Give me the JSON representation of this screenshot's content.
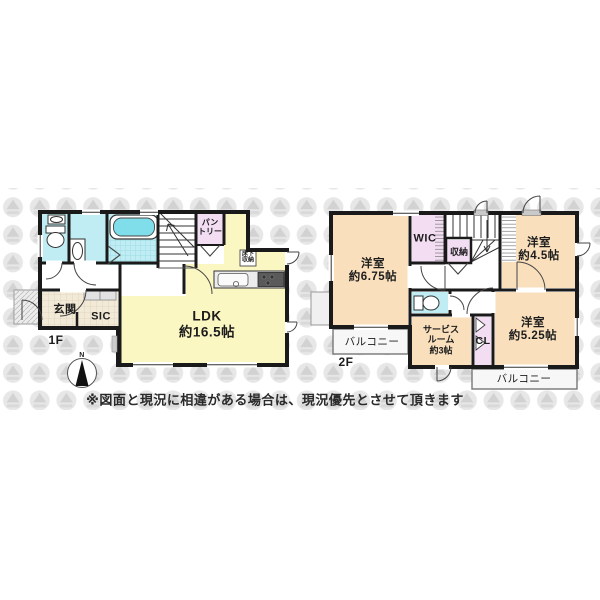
{
  "floor1": {
    "floor_label": "1F",
    "rooms": {
      "ldk": {
        "line1": "LDK",
        "line2": "約16.5帖"
      },
      "genkan": {
        "label": "玄関"
      },
      "sic": {
        "label": "SIC"
      },
      "pantry": {
        "line1": "パン",
        "line2": "トリー"
      },
      "underfloor_storage": {
        "line1": "床下",
        "line2": "収納"
      }
    }
  },
  "floor2": {
    "floor_label": "2F",
    "rooms": {
      "bedroom_675": {
        "line1": "洋室",
        "line2": "約6.75帖"
      },
      "bedroom_45": {
        "line1": "洋室",
        "line2": "約4.5帖"
      },
      "bedroom_525": {
        "line1": "洋室",
        "line2": "約5.25帖"
      },
      "wic": {
        "label": "WIC"
      },
      "storage": {
        "label": "収納"
      },
      "service_room": {
        "line1": "サービス",
        "line2": "ルーム",
        "line3": "約3帖"
      },
      "closet": {
        "label": "CL"
      },
      "balcony_left": {
        "label": "バルコニー"
      },
      "balcony_right": {
        "label": "バルコニー"
      }
    }
  },
  "compass": {
    "north_label": "N"
  },
  "notes": {
    "disclaimer": "※図面と現況に相違がある場合は、現況優先とさせて頂きます"
  },
  "colors": {
    "wall": "#1a1a1a",
    "ldk_yellow": "#fbf7c3",
    "bedroom_peach": "#f9dfbc",
    "closet_lavender": "#f2ddf2",
    "wet_area_cyan": "#bfedf3",
    "bathtub_cyan": "#7fdeea",
    "genkan_beige": "#f2e9d6",
    "balcony_gray": "#f7f7f7",
    "watermark_gray": "#e7e7e7"
  }
}
